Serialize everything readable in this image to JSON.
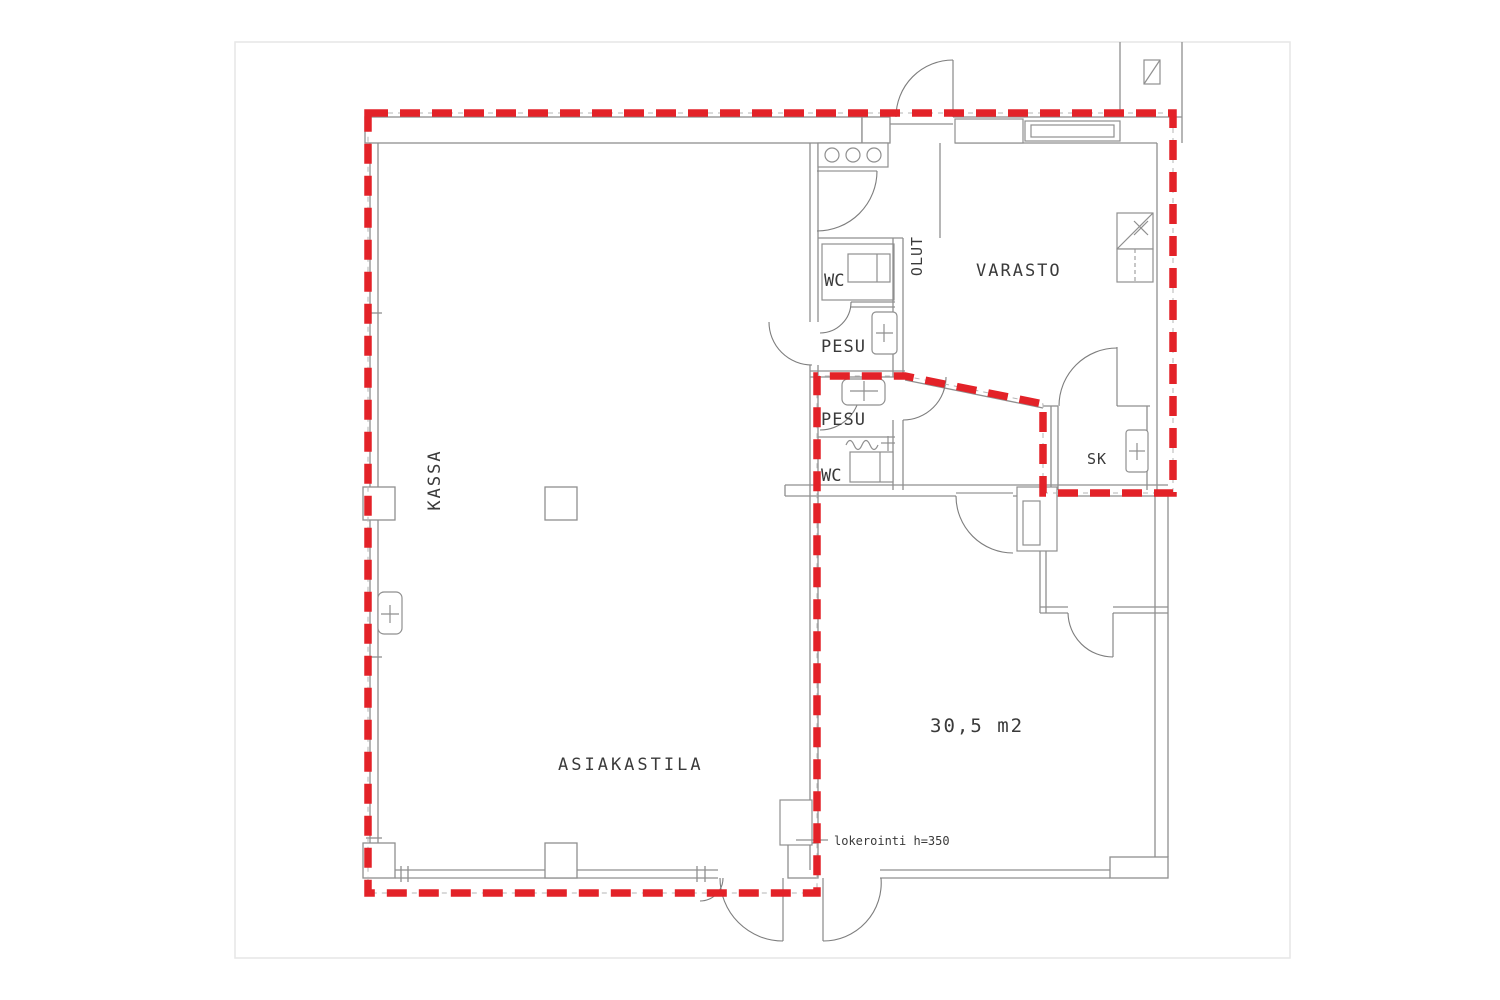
{
  "plan": {
    "rooms": {
      "kassa": "KASSA",
      "asiakastila": "ASIAKASTILA",
      "varasto": "VARASTO",
      "olut": "OLUT",
      "sk": "SK",
      "wc_top": "WC",
      "pesu_top": "PESU",
      "pesu_bottom": "PESU",
      "wc_bottom": "WC"
    },
    "annotations": {
      "area": "30,5 m2",
      "lokerointi": "lokerointi h=350"
    },
    "colors": {
      "highlight_red": "#e32228",
      "wall_gray": "#8f8f8f",
      "text_dark": "#3a3a3a"
    }
  }
}
